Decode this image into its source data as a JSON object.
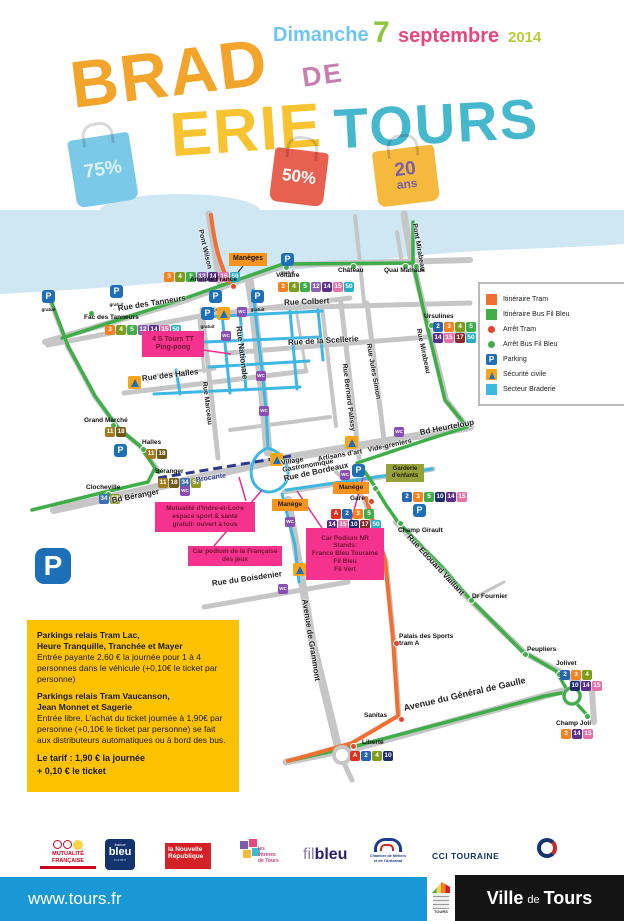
{
  "theme": {
    "css_vars": "--tram:#f26f31;--tramstop:#e8432d;--bus:#3fae49;--braderie:#3db7e4;--brocante:#2b3990;--pk:#1d6fb8;--wc:#8a4fb5;--sec:#f9a51a;--accentpink:#ef2b8d;--orange:#f7941d;--yellowbox:#fcc200;--footerblue:#1899d6;--river:#cfe7f3"
  },
  "header": {
    "day": "Dimanche",
    "day_number": "7",
    "month": "septembre",
    "year": "2014",
    "title_brad": "BRAD",
    "title_erie": "ERIE",
    "title_de": "DE",
    "title_tours": "TOURS",
    "bag_blue": "75%",
    "bag_red": "50%",
    "bag_yellow_top": "20",
    "bag_yellow_bottom": "ans"
  },
  "legend": {
    "items": [
      "Itinéraire Tram",
      "Itinéraire Bus Fil Bleu",
      "Arrêt Tram",
      "Arrêt Bus Fil Bleu",
      "Parking",
      "Sécurité civile",
      "Secteur Braderie"
    ]
  },
  "map": {
    "street_labels": [
      {
        "text": "Pont Wilson",
        "x": 200,
        "y": 16,
        "rot": 77,
        "size": 7
      },
      {
        "text": "Pont Mirabeau",
        "x": 414,
        "y": 10,
        "rot": 80,
        "size": 7
      },
      {
        "text": "Rue des Tanneurs",
        "x": 118,
        "y": 95,
        "rot": -9,
        "size": 8
      },
      {
        "text": "Rue Colbert",
        "x": 284,
        "y": 89,
        "rot": -2,
        "size": 8
      },
      {
        "text": "Rue Nationale",
        "x": 238,
        "y": 112,
        "rot": 83,
        "size": 8
      },
      {
        "text": "Rue de la Scellerie",
        "x": 288,
        "y": 129,
        "rot": -3,
        "size": 8
      },
      {
        "text": "Rue des Halles",
        "x": 142,
        "y": 165,
        "rot": -7,
        "size": 8
      },
      {
        "text": "Rue Marceau",
        "x": 204,
        "y": 168,
        "rot": 83,
        "size": 7
      },
      {
        "text": "Rue Bernard Palissy",
        "x": 344,
        "y": 150,
        "rot": 83,
        "size": 7
      },
      {
        "text": "Rue Jules Simon",
        "x": 368,
        "y": 130,
        "rot": 80,
        "size": 7
      },
      {
        "text": "Rue Mirabeau",
        "x": 418,
        "y": 115,
        "rot": 78,
        "size": 7
      },
      {
        "text": "Bd Heurteloup",
        "x": 420,
        "y": 219,
        "rot": -11,
        "size": 8
      },
      {
        "text": "Vide-greniers",
        "x": 368,
        "y": 237,
        "rot": -12,
        "size": 7
      },
      {
        "text": "Artisans d'art",
        "x": 318,
        "y": 246,
        "rot": -10,
        "size": 7
      },
      {
        "text": "Village\nGastronomique",
        "x": 282,
        "y": 250,
        "rot": -10,
        "size": 7
      },
      {
        "text": "Bd Béranger",
        "x": 112,
        "y": 287,
        "rot": -11,
        "size": 8
      },
      {
        "text": "Brocante",
        "x": 196,
        "y": 267,
        "rot": -9,
        "size": 7,
        "color": "#2b3990"
      },
      {
        "text": "Rue de Bordeaux",
        "x": 284,
        "y": 265,
        "rot": -12,
        "size": 8
      },
      {
        "text": "Rue du Boisdenier",
        "x": 212,
        "y": 370,
        "rot": -8,
        "size": 8
      },
      {
        "text": "Avenue de Grammont",
        "x": 304,
        "y": 385,
        "rot": 81,
        "size": 8
      },
      {
        "text": "Rue Edouard Vaillant",
        "x": 408,
        "y": 322,
        "rot": 47,
        "size": 8
      },
      {
        "text": "Avenue du Général de Gaulle",
        "x": 404,
        "y": 494,
        "rot": -13,
        "size": 9
      }
    ],
    "stop_labels": [
      {
        "text": "Anatole France",
        "x": 190,
        "y": 66
      },
      {
        "text": "Voltaire",
        "x": 276,
        "y": 62
      },
      {
        "text": "Fac des Tanneurs",
        "x": 84,
        "y": 104
      },
      {
        "text": "Ursulines",
        "x": 424,
        "y": 103
      },
      {
        "text": "Château",
        "x": 338,
        "y": 57
      },
      {
        "text": "Quai Malraux",
        "x": 384,
        "y": 57
      },
      {
        "text": "Grand Marché",
        "x": 84,
        "y": 207
      },
      {
        "text": "Halles",
        "x": 142,
        "y": 229
      },
      {
        "text": "Béranger",
        "x": 155,
        "y": 258
      },
      {
        "text": "Clocheville",
        "x": 86,
        "y": 274
      },
      {
        "text": "Gare",
        "x": 350,
        "y": 285
      },
      {
        "text": "Champ Girault",
        "x": 398,
        "y": 317
      },
      {
        "text": "Dr Fournier",
        "x": 472,
        "y": 383
      },
      {
        "text": "Peupliers",
        "x": 527,
        "y": 436
      },
      {
        "text": "Palais des Sports\ntram A",
        "x": 399,
        "y": 423
      },
      {
        "text": "Jolivet",
        "x": 556,
        "y": 450
      },
      {
        "text": "Champ Joli",
        "x": 556,
        "y": 510
      },
      {
        "text": "Sanitas",
        "x": 364,
        "y": 502
      },
      {
        "text": "Liberté",
        "x": 362,
        "y": 529
      }
    ],
    "badges": [
      {
        "text": "3",
        "x": 164,
        "y": 62,
        "bg": "#f58220"
      },
      {
        "text": "4",
        "x": 175,
        "y": 62,
        "bg": "#7f9c1c"
      },
      {
        "text": "5",
        "x": 186,
        "y": 62,
        "bg": "#3fae49"
      },
      {
        "text": "12",
        "x": 197,
        "y": 62,
        "bg": "#8a63b0"
      },
      {
        "text": "14",
        "x": 208,
        "y": 62,
        "bg": "#5c2e87"
      },
      {
        "text": "15",
        "x": 219,
        "y": 62,
        "bg": "#e671a8"
      },
      {
        "text": "50",
        "x": 230,
        "y": 62,
        "bg": "#2aaec4"
      },
      {
        "text": "3",
        "x": 278,
        "y": 72,
        "bg": "#f58220"
      },
      {
        "text": "4",
        "x": 289,
        "y": 72,
        "bg": "#7f9c1c"
      },
      {
        "text": "5",
        "x": 300,
        "y": 72,
        "bg": "#3fae49"
      },
      {
        "text": "12",
        "x": 311,
        "y": 72,
        "bg": "#8a63b0"
      },
      {
        "text": "14",
        "x": 322,
        "y": 72,
        "bg": "#5c2e87"
      },
      {
        "text": "15",
        "x": 333,
        "y": 72,
        "bg": "#e671a8"
      },
      {
        "text": "50",
        "x": 344,
        "y": 72,
        "bg": "#2aaec4"
      },
      {
        "text": "3",
        "x": 105,
        "y": 115,
        "bg": "#f58220"
      },
      {
        "text": "4",
        "x": 116,
        "y": 115,
        "bg": "#7f9c1c"
      },
      {
        "text": "5",
        "x": 127,
        "y": 115,
        "bg": "#3fae49"
      },
      {
        "text": "12",
        "x": 138,
        "y": 115,
        "bg": "#8a63b0"
      },
      {
        "text": "14",
        "x": 149,
        "y": 115,
        "bg": "#5c2e87"
      },
      {
        "text": "15",
        "x": 160,
        "y": 115,
        "bg": "#e671a8"
      },
      {
        "text": "50",
        "x": 171,
        "y": 115,
        "bg": "#2aaec4"
      },
      {
        "text": "2",
        "x": 433,
        "y": 112,
        "bg": "#2566af"
      },
      {
        "text": "3",
        "x": 444,
        "y": 112,
        "bg": "#f58220"
      },
      {
        "text": "4",
        "x": 455,
        "y": 112,
        "bg": "#7f9c1c"
      },
      {
        "text": "5",
        "x": 466,
        "y": 112,
        "bg": "#3fae49"
      },
      {
        "text": "14",
        "x": 433,
        "y": 123,
        "bg": "#5c2e87"
      },
      {
        "text": "15",
        "x": 444,
        "y": 123,
        "bg": "#e671a8"
      },
      {
        "text": "17",
        "x": 455,
        "y": 123,
        "bg": "#8a2a2a"
      },
      {
        "text": "50",
        "x": 466,
        "y": 123,
        "bg": "#2aaec4"
      },
      {
        "text": "11",
        "x": 105,
        "y": 217,
        "bg": "#a07c1e"
      },
      {
        "text": "18",
        "x": 116,
        "y": 217,
        "bg": "#6e5a14"
      },
      {
        "text": "11",
        "x": 146,
        "y": 239,
        "bg": "#a07c1e"
      },
      {
        "text": "18",
        "x": 157,
        "y": 239,
        "bg": "#6e5a14"
      },
      {
        "text": "11",
        "x": 158,
        "y": 268,
        "bg": "#a07c1e"
      },
      {
        "text": "18",
        "x": 169,
        "y": 268,
        "bg": "#6e5a14"
      },
      {
        "text": "34",
        "x": 180,
        "y": 268,
        "bg": "#3f6eb5"
      },
      {
        "text": "57",
        "x": 191,
        "y": 268,
        "bg": "#8f9a1f"
      },
      {
        "text": "34",
        "x": 99,
        "y": 284,
        "bg": "#3f6eb5"
      },
      {
        "text": "57",
        "x": 110,
        "y": 284,
        "bg": "#8f9a1f"
      },
      {
        "text": "A",
        "x": 331,
        "y": 299,
        "bg": "#e0301e"
      },
      {
        "text": "2",
        "x": 342,
        "y": 299,
        "bg": "#2566af"
      },
      {
        "text": "3",
        "x": 353,
        "y": 299,
        "bg": "#f58220"
      },
      {
        "text": "5",
        "x": 364,
        "y": 299,
        "bg": "#3fae49"
      },
      {
        "text": "14",
        "x": 327,
        "y": 310,
        "bg": "#5c2e87"
      },
      {
        "text": "15",
        "x": 338,
        "y": 310,
        "bg": "#e671a8"
      },
      {
        "text": "10",
        "x": 349,
        "y": 310,
        "bg": "#1f2d6e"
      },
      {
        "text": "17",
        "x": 360,
        "y": 310,
        "bg": "#8a2a2a"
      },
      {
        "text": "50",
        "x": 371,
        "y": 310,
        "bg": "#2aaec4"
      },
      {
        "text": "2",
        "x": 402,
        "y": 282,
        "bg": "#2566af"
      },
      {
        "text": "3",
        "x": 413,
        "y": 282,
        "bg": "#f58220"
      },
      {
        "text": "5",
        "x": 424,
        "y": 282,
        "bg": "#3fae49"
      },
      {
        "text": "10",
        "x": 435,
        "y": 282,
        "bg": "#1f2d6e"
      },
      {
        "text": "14",
        "x": 446,
        "y": 282,
        "bg": "#5c2e87"
      },
      {
        "text": "15",
        "x": 457,
        "y": 282,
        "bg": "#e671a8"
      },
      {
        "text": "2",
        "x": 560,
        "y": 460,
        "bg": "#2566af"
      },
      {
        "text": "3",
        "x": 571,
        "y": 460,
        "bg": "#f58220"
      },
      {
        "text": "4",
        "x": 582,
        "y": 460,
        "bg": "#7f9c1c"
      },
      {
        "text": "10",
        "x": 570,
        "y": 471,
        "bg": "#1f2d6e"
      },
      {
        "text": "14",
        "x": 581,
        "y": 471,
        "bg": "#5c2e87"
      },
      {
        "text": "15",
        "x": 592,
        "y": 471,
        "bg": "#e671a8"
      },
      {
        "text": "3",
        "x": 561,
        "y": 519,
        "bg": "#f58220"
      },
      {
        "text": "14",
        "x": 572,
        "y": 519,
        "bg": "#5c2e87"
      },
      {
        "text": "15",
        "x": 583,
        "y": 519,
        "bg": "#e671a8"
      },
      {
        "text": "A",
        "x": 350,
        "y": 541,
        "bg": "#e0301e"
      },
      {
        "text": "2",
        "x": 361,
        "y": 541,
        "bg": "#2566af"
      },
      {
        "text": "4",
        "x": 372,
        "y": 541,
        "bg": "#7f9c1c"
      },
      {
        "text": "10",
        "x": 383,
        "y": 541,
        "bg": "#1f2d6e"
      }
    ],
    "tram_stops": [
      {
        "x": 230,
        "y": 73,
        "bg": "#e8432d"
      },
      {
        "x": 368,
        "y": 288,
        "bg": "#e8432d"
      },
      {
        "x": 393,
        "y": 430,
        "bg": "#e8432d"
      },
      {
        "x": 398,
        "y": 506,
        "bg": "#e8432d"
      },
      {
        "x": 350,
        "y": 533,
        "bg": "#e8432d"
      }
    ],
    "bus_stops": [
      {
        "x": 88,
        "y": 100,
        "bg": "#3fae49"
      },
      {
        "x": 283,
        "y": 54,
        "bg": "#3fae49"
      },
      {
        "x": 350,
        "y": 53,
        "bg": "#3fae49"
      },
      {
        "x": 402,
        "y": 53,
        "bg": "#3fae49"
      },
      {
        "x": 413,
        "y": 53,
        "bg": "#3fae49"
      },
      {
        "x": 428,
        "y": 112,
        "bg": "#3fae49"
      },
      {
        "x": 110,
        "y": 212,
        "bg": "#3fae49"
      },
      {
        "x": 140,
        "y": 236,
        "bg": "#3fae49"
      },
      {
        "x": 155,
        "y": 258,
        "bg": "#3fae49"
      },
      {
        "x": 105,
        "y": 281,
        "bg": "#3fae49"
      },
      {
        "x": 372,
        "y": 275,
        "bg": "#3fae49"
      },
      {
        "x": 397,
        "y": 310,
        "bg": "#3fae49"
      },
      {
        "x": 468,
        "y": 387,
        "bg": "#3fae49"
      },
      {
        "x": 522,
        "y": 441,
        "bg": "#3fae49"
      },
      {
        "x": 556,
        "y": 461,
        "bg": "#3fae49"
      },
      {
        "x": 584,
        "y": 503,
        "bg": "#3fae49"
      }
    ],
    "parkings": [
      {
        "text": "P",
        "label": "gratuit",
        "x": 42,
        "y": 80
      },
      {
        "text": "P",
        "label": "gratuit",
        "x": 110,
        "y": 75
      },
      {
        "text": "P",
        "label": "3€/jour",
        "x": 209,
        "y": 80
      },
      {
        "text": "P",
        "label": "gratuit",
        "x": 201,
        "y": 97
      },
      {
        "text": "P",
        "label": "gratuit",
        "x": 251,
        "y": 80
      },
      {
        "text": "P",
        "label": "gratuit",
        "x": 281,
        "y": 43
      },
      {
        "text": "P",
        "label": "",
        "x": 114,
        "y": 234
      },
      {
        "text": "P",
        "label": "3€/jour",
        "x": 352,
        "y": 254
      },
      {
        "text": "P",
        "label": "",
        "x": 413,
        "y": 294
      }
    ],
    "wcs": [
      {
        "text": "WC",
        "x": 237,
        "y": 97
      },
      {
        "text": "WC",
        "x": 221,
        "y": 121
      },
      {
        "text": "WC",
        "x": 256,
        "y": 161
      },
      {
        "text": "WC",
        "x": 259,
        "y": 196
      },
      {
        "text": "WC",
        "x": 180,
        "y": 276
      },
      {
        "text": "WC",
        "x": 394,
        "y": 217
      },
      {
        "text": "WC",
        "x": 340,
        "y": 260
      },
      {
        "text": "WC",
        "x": 285,
        "y": 307
      },
      {
        "text": "WC",
        "x": 278,
        "y": 374
      }
    ],
    "securites": [
      {
        "x": 217,
        "y": 97
      },
      {
        "x": 128,
        "y": 166
      },
      {
        "x": 270,
        "y": 243
      },
      {
        "x": 345,
        "y": 226
      },
      {
        "x": 293,
        "y": 353
      }
    ],
    "event_boxes": [
      {
        "text": "Manèges",
        "x": 229,
        "y": 43,
        "w": 38,
        "h": 13,
        "bg": "#f7941d",
        "color": "#1a1a1a",
        "size": 7
      },
      {
        "text": "Manège",
        "x": 333,
        "y": 272,
        "w": 36,
        "h": 12,
        "bg": "#f7941d",
        "color": "#1a1a1a",
        "size": 6.5
      },
      {
        "text": "Manège",
        "x": 272,
        "y": 289,
        "w": 36,
        "h": 12,
        "bg": "#f7941d",
        "color": "#1a1a1a",
        "size": 6.5
      },
      {
        "text": "4 S Tours TT\nPing-pong",
        "x": 142,
        "y": 121,
        "w": 62,
        "h": 26,
        "bg": "#f5338f",
        "color": "#701432",
        "size": 7
      },
      {
        "text": "Mutualité d'Indre-et-Loire\nespace sport & santé\ngratuit- ouvert à tous",
        "x": 155,
        "y": 292,
        "w": 100,
        "h": 30,
        "bg": "#f5338f",
        "color": "#701432",
        "size": 6.5
      },
      {
        "text": "Car podium de la Française\ndes jeux",
        "x": 188,
        "y": 336,
        "w": 94,
        "h": 20,
        "bg": "#f5338f",
        "color": "#701432",
        "size": 6.5
      },
      {
        "text": "Car Podium NR\nStands:\nFrance Bleu Touraine\nFil Bleu\nFil Vert",
        "x": 306,
        "y": 318,
        "w": 78,
        "h": 52,
        "bg": "#f5338f",
        "color": "#701432",
        "size": 6.5
      },
      {
        "text": "Garderie\nd'enfants",
        "x": 386,
        "y": 254,
        "w": 38,
        "h": 18,
        "bg": "#97a13b",
        "color": "#1f2000",
        "size": 6
      }
    ]
  },
  "parking_info": {
    "p": "P",
    "heading1": "Parkings relais Tram Lac,\nHeure Tranquille, Tranchée et Mayer",
    "body1": "Entrée payante 2,60 € la journée pour 1 à 4 personnes dans le véhicule (+0,10€ le ticket par personne)",
    "heading2": "Parkings relais Tram Vaucanson,\nJean Monnet et Sagerie",
    "body2": "Entrée libre, L'achat du ticket journée à 1,90€ par personne (+0,10€ le ticket par personne) se fait aux distributeurs automatiques ou à bord des bus.",
    "tariff": "Le tarif : 1,90 € la journée\n+ 0,10 € le ticket"
  },
  "logos": {
    "mutualite_line1": "MUTUALITÉ",
    "mutualite_line2": "FRANÇAISE",
    "france_bleu_top": "france",
    "france_bleu_main": "bleu",
    "france_bleu_sub": "touraine",
    "nouvelle_republique": "la Nouvelle\nRépublique",
    "vitrines": "les\nvitrines\nde Tours",
    "fil": "fil",
    "bleu": "bleu",
    "cma": "Chambre de Métiers\net de l'Artisanat",
    "cci": "CCI TOURAINE"
  },
  "footer": {
    "url": "www.tours.fr",
    "tours_logo": "TOURS",
    "ville": "Ville",
    "de": "de",
    "tours": "Tours"
  }
}
